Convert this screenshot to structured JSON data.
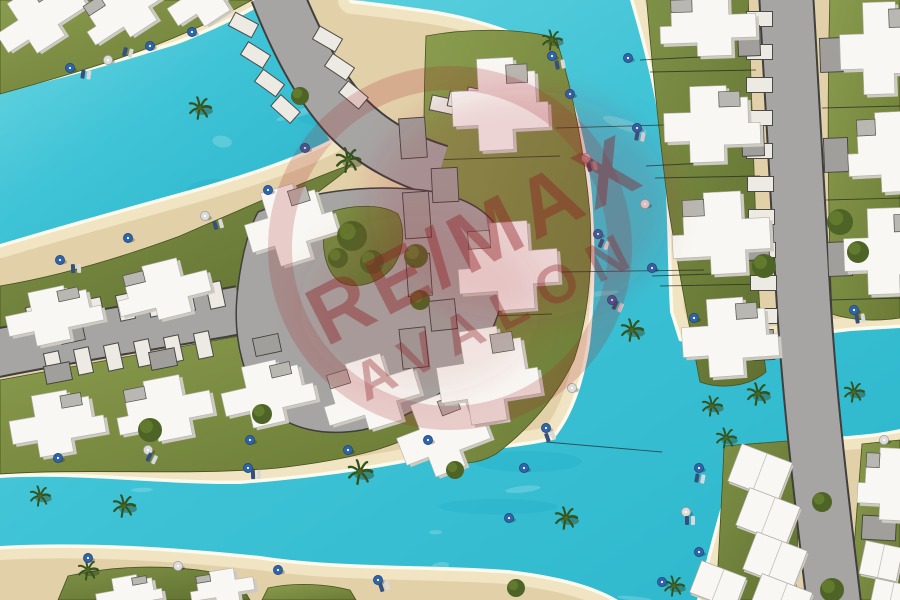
{
  "watermark": {
    "line1": "RE/MAX",
    "line2": "AVALON"
  },
  "palette": {
    "water": "#3fc3d6",
    "water_deep": "#17a6c0",
    "foam": "#fbfcf2",
    "sand": "#e2d0a8",
    "sand_bright": "#f1e4c2",
    "grass": "#7c8d42",
    "grass_dark": "#46511f",
    "road": "#a6a5a3",
    "road_outline": "#3f3f3d",
    "roof": "#f8f7f3",
    "roof_shadow": "#cdcac2",
    "driveway": "#a09f9b",
    "umbrella_blue": "#2f64a8",
    "umbrella_white": "#dcdcda",
    "watermark_red": "#8e1b20"
  }
}
